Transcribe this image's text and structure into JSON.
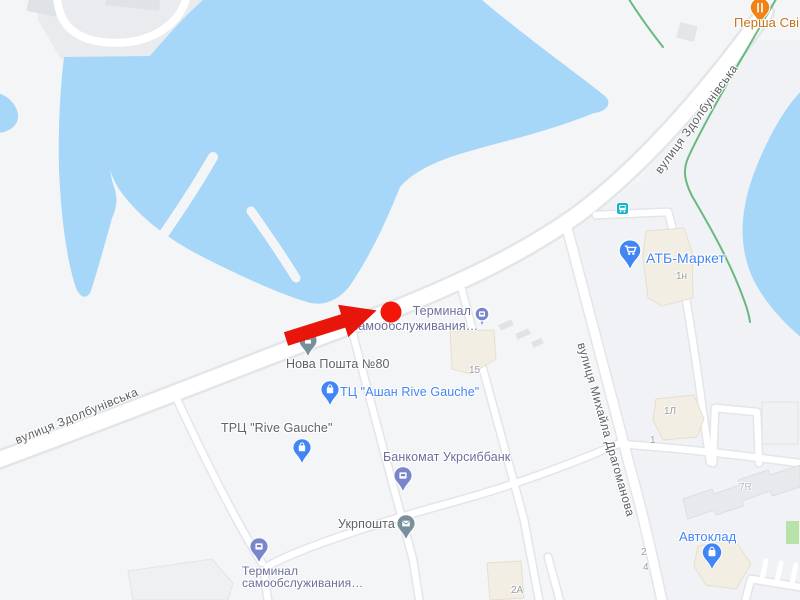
{
  "map": {
    "streets": {
      "zdolbunivska_left": "вулиця Здолбунівська",
      "zdolbunivska_upper": "вулиця Здолбунівська",
      "drahomanova": "вулиця Михайла Драгоманова"
    },
    "pois": {
      "persha_svi": {
        "label": "Перша Сві",
        "type": "restaurant"
      },
      "atb_market": {
        "label": "АТБ-Маркет",
        "type": "supermarket"
      },
      "terminal_center": {
        "label_line1": "Терминал",
        "label_line2": "самообслуживания…",
        "type": "atm-terminal"
      },
      "nova_poshta": {
        "label": "Нова Пошта №80",
        "type": "post-office"
      },
      "auchan": {
        "label": "ТЦ \"Ашан Rive Gauche\"",
        "type": "shopping-mall"
      },
      "rive_gauche": {
        "label": "ТРЦ \"Rive Gauche\"",
        "type": "shopping-mall"
      },
      "ukrsibbank_atm": {
        "label": "Банкомат Укрсиббанк",
        "type": "atm"
      },
      "ukrposhta": {
        "label": "Укрпошта",
        "type": "post-office"
      },
      "terminal_bottom": {
        "label_line1": "Терминал",
        "label_line2": "самообслуживания…",
        "type": "atm-terminal"
      },
      "avtoklad": {
        "label": "Автоклад",
        "type": "store"
      }
    },
    "house_numbers": {
      "b15": "15",
      "b1n": "1н",
      "b1l": "1Л",
      "b1": "1",
      "b2": "2",
      "b4": "4",
      "b2a": "2А",
      "b7r": "7R"
    },
    "colors": {
      "water": "#A7D7F8",
      "land": "#F4F5F7",
      "road": "#FFFFFF",
      "road_outline": "#E3E5E9",
      "trail_green": "#3DA65A",
      "building_beige": "#F3EEE3",
      "building_gray": "#E7E9EC",
      "poi_blue": "#4285F4",
      "poi_indigo": "#7986CB",
      "poi_slate": "#78909C",
      "poi_orange": "#F08316",
      "transit_teal": "#12B5C9",
      "highlight_red": "#E8150B"
    }
  }
}
